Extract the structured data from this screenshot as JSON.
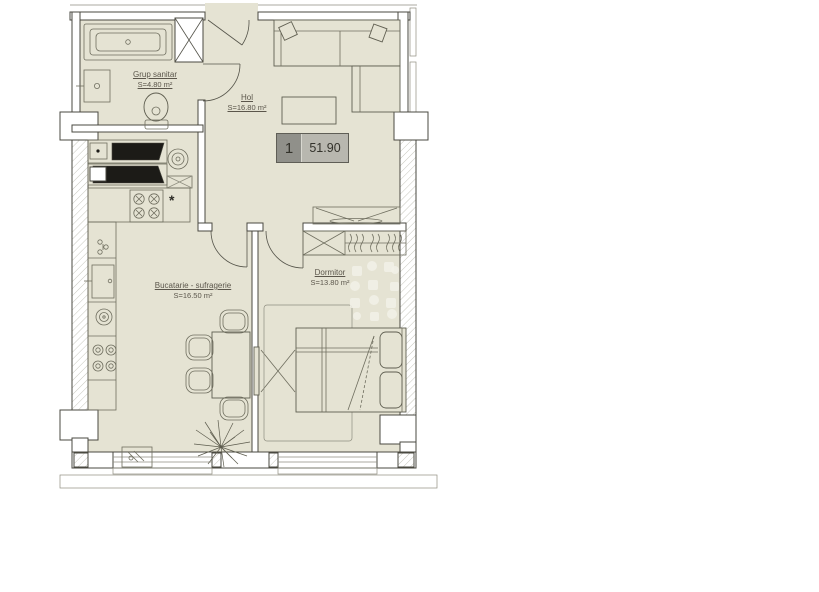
{
  "floor_plan": {
    "unit_badge": {
      "number": "1",
      "total_area": "51.90"
    },
    "rooms": [
      {
        "name": "Grup sanitar",
        "area": "S=4.80 m²"
      },
      {
        "name": "Hol",
        "area": "S=16.80 m²"
      },
      {
        "name": "Bucatarie - sufragerie",
        "area": "S=16.50 m²"
      },
      {
        "name": "Dormitor",
        "area": "S=13.80 m²"
      }
    ],
    "annotations": {
      "boiler_marker": "*"
    },
    "colors": {
      "floor": "#e5e3d3",
      "wall_line": "#4a4940",
      "badge_number_bg": "#90908a",
      "badge_area_bg": "#b8b7af",
      "label_text": "#5b564b"
    }
  }
}
